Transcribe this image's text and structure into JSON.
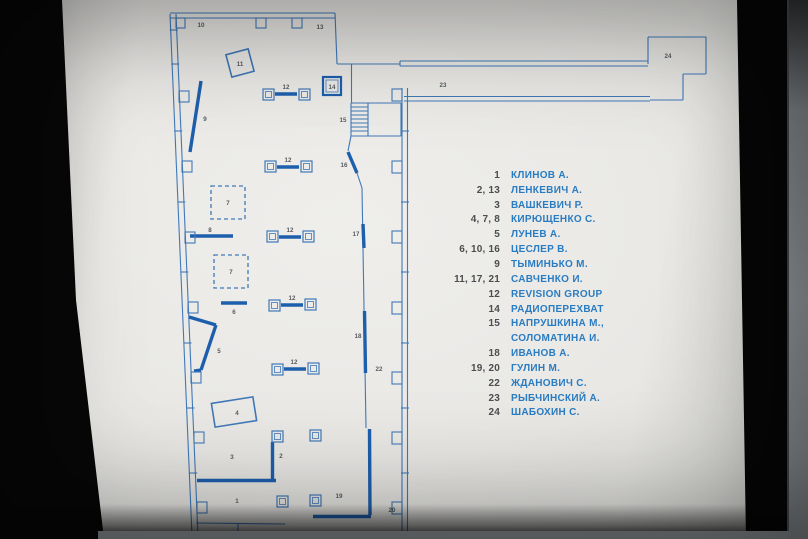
{
  "scene": {
    "description": "Backlit exhibition floor-plan sign, blueprint style",
    "colors": {
      "board": "#e9e8e5",
      "plan_line": "#4079b8",
      "plan_thick": "#1e5fad",
      "plan_label": "#575b60",
      "legend_number": "#4b4d50",
      "legend_name": "#2a7cc2"
    }
  },
  "plan": {
    "colors": {
      "line": "#4079b8",
      "thick": "#1e5fad",
      "label": "#575b60"
    },
    "thin_lines": [
      [
        170,
        14,
        192,
        536
      ],
      [
        176,
        14,
        198,
        536
      ],
      [
        170,
        13,
        335,
        13
      ],
      [
        170,
        18,
        335,
        18
      ],
      [
        169.7,
        30,
        177.7,
        30
      ],
      [
        171.2,
        64,
        179.2,
        64
      ],
      [
        174.2,
        131,
        182.2,
        131
      ],
      [
        177.3,
        202,
        185.3,
        202
      ],
      [
        180.4,
        272,
        188.4,
        272
      ],
      [
        183.5,
        343,
        191.5,
        343
      ],
      [
        186.4,
        408,
        194.4,
        408
      ],
      [
        189.2,
        473,
        197.2,
        473
      ],
      [
        335,
        13,
        337,
        64
      ],
      [
        337,
        64,
        400,
        64
      ],
      [
        400,
        61,
        648,
        61
      ],
      [
        400,
        66,
        648,
        66
      ],
      [
        400,
        61,
        400,
        66
      ],
      [
        648,
        64,
        648,
        37
      ],
      [
        648,
        37,
        706,
        37
      ],
      [
        706,
        37,
        706,
        74
      ],
      [
        706,
        74,
        683,
        74
      ],
      [
        683,
        74,
        683,
        100
      ],
      [
        683,
        100,
        650,
        100
      ],
      [
        404,
        96.5,
        650,
        96.5
      ],
      [
        404,
        101,
        650,
        101
      ],
      [
        402,
        88,
        402,
        539
      ],
      [
        407.5,
        88,
        407.5,
        539
      ],
      [
        401,
        131,
        409,
        131
      ],
      [
        401,
        202,
        409,
        202
      ],
      [
        401,
        272,
        409,
        272
      ],
      [
        401,
        343,
        409,
        343
      ],
      [
        401,
        408,
        409,
        408
      ],
      [
        401,
        473,
        409,
        473
      ],
      [
        351.5,
        64,
        351.5,
        103
      ],
      [
        351,
        103,
        401,
        103
      ],
      [
        351,
        136,
        401,
        136
      ],
      [
        351,
        103,
        351,
        136
      ],
      [
        401,
        103,
        401,
        136
      ],
      [
        368,
        103,
        368,
        136
      ],
      [
        351,
        107,
        368,
        107
      ],
      [
        351,
        111,
        368,
        111
      ],
      [
        351,
        115,
        368,
        115
      ],
      [
        351,
        119,
        368,
        119
      ],
      [
        351,
        123,
        368,
        123
      ],
      [
        351,
        127,
        368,
        127
      ],
      [
        351,
        131,
        368,
        131
      ],
      [
        351,
        136,
        348,
        151
      ],
      [
        357,
        173,
        362,
        188
      ],
      [
        362,
        188,
        366,
        428
      ],
      [
        196,
        523,
        285,
        524
      ],
      [
        238,
        524,
        238,
        539
      ]
    ],
    "thick_lines": [
      [
        201,
        81,
        190,
        152
      ],
      [
        348,
        152,
        357,
        173
      ],
      [
        363,
        224,
        364,
        248
      ],
      [
        364.5,
        311,
        365.5,
        373
      ],
      [
        369.5,
        429,
        370,
        515
      ],
      [
        313,
        516.5,
        371,
        516.5
      ],
      [
        272.5,
        442,
        272.5,
        479
      ],
      [
        197,
        480.5,
        276,
        480.5
      ],
      [
        190,
        236,
        233,
        236
      ],
      [
        221,
        303,
        247,
        303
      ],
      [
        275,
        94,
        297,
        94
      ],
      [
        277,
        167,
        299,
        167
      ],
      [
        279,
        237,
        301,
        237
      ],
      [
        281,
        305,
        303,
        305
      ],
      [
        284,
        369,
        306,
        369
      ],
      [
        189,
        317,
        216,
        325
      ],
      [
        216,
        325,
        201,
        370
      ],
      [
        201,
        370,
        194,
        371
      ]
    ],
    "wall_squares": [
      [
        179,
        91,
        10,
        11
      ],
      [
        182,
        161,
        10,
        11
      ],
      [
        185,
        232,
        10,
        11
      ],
      [
        188,
        302,
        10,
        11
      ],
      [
        191,
        372,
        10,
        11
      ],
      [
        194,
        432,
        10,
        11
      ],
      [
        197,
        502,
        10,
        11
      ],
      [
        176,
        18,
        9,
        10
      ],
      [
        256,
        18,
        10,
        10
      ],
      [
        292,
        18,
        10,
        10
      ],
      [
        392,
        89,
        10,
        12
      ],
      [
        392,
        161,
        10,
        12
      ],
      [
        392,
        231,
        10,
        12
      ],
      [
        392,
        302,
        10,
        12
      ],
      [
        392,
        372,
        10,
        12
      ],
      [
        392,
        432,
        10,
        12
      ],
      [
        392,
        502,
        10,
        12
      ]
    ],
    "columns": [
      [
        263,
        89
      ],
      [
        299,
        89
      ],
      [
        265,
        161
      ],
      [
        301,
        161
      ],
      [
        267,
        231
      ],
      [
        303,
        231
      ],
      [
        269,
        300
      ],
      [
        305,
        299
      ],
      [
        272,
        364
      ],
      [
        308,
        363
      ],
      [
        272,
        431
      ],
      [
        310,
        430
      ],
      [
        277,
        496
      ],
      [
        310,
        495
      ]
    ],
    "dashed_squares": [
      [
        211,
        186,
        34,
        33
      ],
      [
        214,
        255,
        34,
        33
      ]
    ],
    "bold_square": [
      323,
      77,
      18,
      18
    ],
    "tilted_frames": [
      {
        "cx": 240,
        "cy": 63,
        "w": 23,
        "h": 23,
        "a": -15
      },
      {
        "cx": 234,
        "cy": 412,
        "w": 42,
        "h": 24,
        "a": -9
      }
    ],
    "labels": [
      {
        "x": 201,
        "y": 25,
        "t": "10"
      },
      {
        "x": 320,
        "y": 27,
        "t": "13"
      },
      {
        "x": 240,
        "y": 64,
        "t": "11"
      },
      {
        "x": 286,
        "y": 87,
        "t": "12"
      },
      {
        "x": 332,
        "y": 87,
        "t": "14"
      },
      {
        "x": 443,
        "y": 85,
        "t": "23"
      },
      {
        "x": 668,
        "y": 56,
        "t": "24"
      },
      {
        "x": 205,
        "y": 119,
        "t": "9"
      },
      {
        "x": 343,
        "y": 120,
        "t": "15"
      },
      {
        "x": 288,
        "y": 160,
        "t": "12"
      },
      {
        "x": 344,
        "y": 165,
        "t": "16"
      },
      {
        "x": 228,
        "y": 203,
        "t": "7"
      },
      {
        "x": 210,
        "y": 230,
        "t": "8"
      },
      {
        "x": 290,
        "y": 230,
        "t": "12"
      },
      {
        "x": 356,
        "y": 234,
        "t": "17"
      },
      {
        "x": 231,
        "y": 272,
        "t": "7"
      },
      {
        "x": 292,
        "y": 298,
        "t": "12"
      },
      {
        "x": 234,
        "y": 312,
        "t": "6"
      },
      {
        "x": 219,
        "y": 351,
        "t": "5"
      },
      {
        "x": 294,
        "y": 362,
        "t": "12"
      },
      {
        "x": 358,
        "y": 336,
        "t": "18"
      },
      {
        "x": 379,
        "y": 369,
        "t": "22"
      },
      {
        "x": 237,
        "y": 413,
        "t": "4"
      },
      {
        "x": 232,
        "y": 457,
        "t": "3"
      },
      {
        "x": 281,
        "y": 456,
        "t": "2"
      },
      {
        "x": 339,
        "y": 496,
        "t": "19"
      },
      {
        "x": 237,
        "y": 501,
        "t": "1"
      },
      {
        "x": 392,
        "y": 510,
        "t": "20"
      }
    ]
  },
  "legend": {
    "rows": [
      {
        "num": "1",
        "name": "КЛИНОВ А."
      },
      {
        "num": "2, 13",
        "name": "ЛЕНКЕВИЧ А."
      },
      {
        "num": "3",
        "name": "ВАШКЕВИЧ Р."
      },
      {
        "num": "4, 7, 8",
        "name": "КИРЮЩЕНКО С."
      },
      {
        "num": "5",
        "name": "ЛУНЕВ А."
      },
      {
        "num": "6, 10, 16",
        "name": "ЦЕСЛЕР В."
      },
      {
        "num": "9",
        "name": "ТЫМИНЬКО М."
      },
      {
        "num": "11, 17, 21",
        "name": "САВЧЕНКО И."
      },
      {
        "num": "12",
        "name": "REVISION GROUP"
      },
      {
        "num": "14",
        "name": "РАДИОПЕРЕХВАТ"
      },
      {
        "num": "15",
        "name": "НАПРУШКИНА М.,"
      },
      {
        "num": "",
        "name": "СОЛОМАТИНА И."
      },
      {
        "num": "18",
        "name": "ИВАНОВ А."
      },
      {
        "num": "19, 20",
        "name": "ГУЛИН М."
      },
      {
        "num": "22",
        "name": "ЖДАНОВИЧ С."
      },
      {
        "num": "23",
        "name": "РЫБЧИНСКИЙ А."
      },
      {
        "num": "24",
        "name": "ШАБОХИН С."
      }
    ]
  }
}
